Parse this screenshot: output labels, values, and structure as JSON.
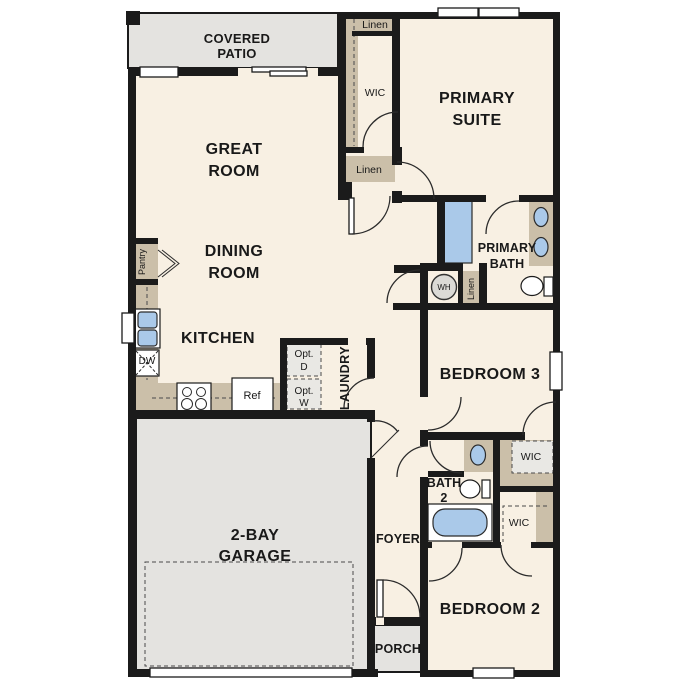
{
  "rooms": {
    "covered_patio": {
      "line1": "COVERED",
      "line2": "PATIO"
    },
    "great_room": {
      "line1": "GREAT",
      "line2": "ROOM"
    },
    "dining_room": {
      "line1": "DINING",
      "line2": "ROOM"
    },
    "kitchen": {
      "label": "KITCHEN"
    },
    "primary_suite": {
      "line1": "PRIMARY",
      "line2": "SUITE"
    },
    "primary_bath": {
      "line1": "PRIMARY",
      "line2": "BATH"
    },
    "bedroom_3": {
      "label": "BEDROOM 3"
    },
    "bath_2": {
      "line1": "BATH",
      "line2": "2"
    },
    "bedroom_2": {
      "label": "BEDROOM 2"
    },
    "garage": {
      "line1": "2-BAY",
      "line2": "GARAGE"
    },
    "foyer": {
      "label": "FOYER"
    },
    "porch": {
      "label": "PORCH"
    },
    "laundry": {
      "label": "LAUNDRY"
    }
  },
  "closets": {
    "linen_upper": "Linen",
    "wic_primary": "WIC",
    "linen_mid": "Linen",
    "linen_hall": "Linen",
    "pantry": "Pantry",
    "wic_bed3": "WIC",
    "wic_bed2": "WIC"
  },
  "appliances": {
    "water_heater": "WH",
    "dishwasher": "DW",
    "refrigerator": "Ref",
    "opt_dryer": {
      "line1": "Opt.",
      "line2": "D"
    },
    "opt_washer": {
      "line1": "Opt.",
      "line2": "W"
    }
  },
  "colors": {
    "wall": "#1b1b1b",
    "floor": "#f8f0e3",
    "outdoor_concrete": "#e4e3e0",
    "cabinetry": "#cbbfa9",
    "plumbing_fixture": "#aac9e9",
    "optional_appliance": "#e9e8e4"
  }
}
